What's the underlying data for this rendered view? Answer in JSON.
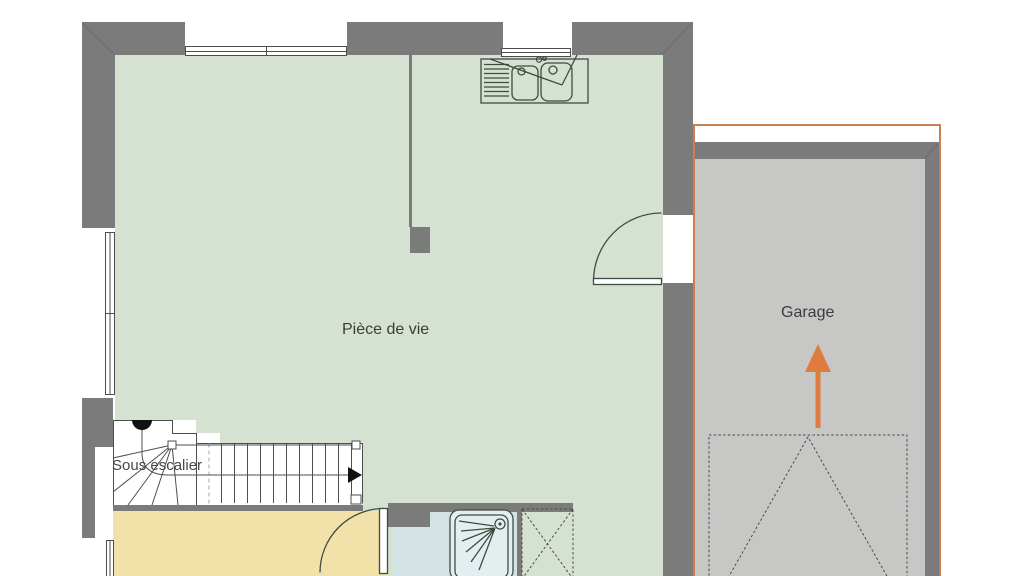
{
  "plan": {
    "type": "floor-plan",
    "labels": {
      "living_room": "Pièce de vie",
      "garage": "Garage",
      "under_stairs": "Sous escalier"
    },
    "fixtures": [
      "kitchen-sink-icon",
      "shower-tray-icon",
      "staircase-icon",
      "stair-direction-arrow-icon",
      "door-swing-icon",
      "garage-door-swing-icon",
      "garage-direction-arrow-icon",
      "window-icon",
      "technical-duct-icon"
    ]
  },
  "colors": {
    "wall": "#7b7b7b",
    "living_room_floor": "#d6e2d1",
    "garage_floor": "#c7c8c6",
    "kitchen_floor": "#f3e1aa",
    "bathroom_floor": "#d3e2e4",
    "garage_outline": "#ca7e53",
    "direction_arrow": "#e07b40",
    "fixture_line": "#3d4d42",
    "text": "#3c3c3c"
  }
}
